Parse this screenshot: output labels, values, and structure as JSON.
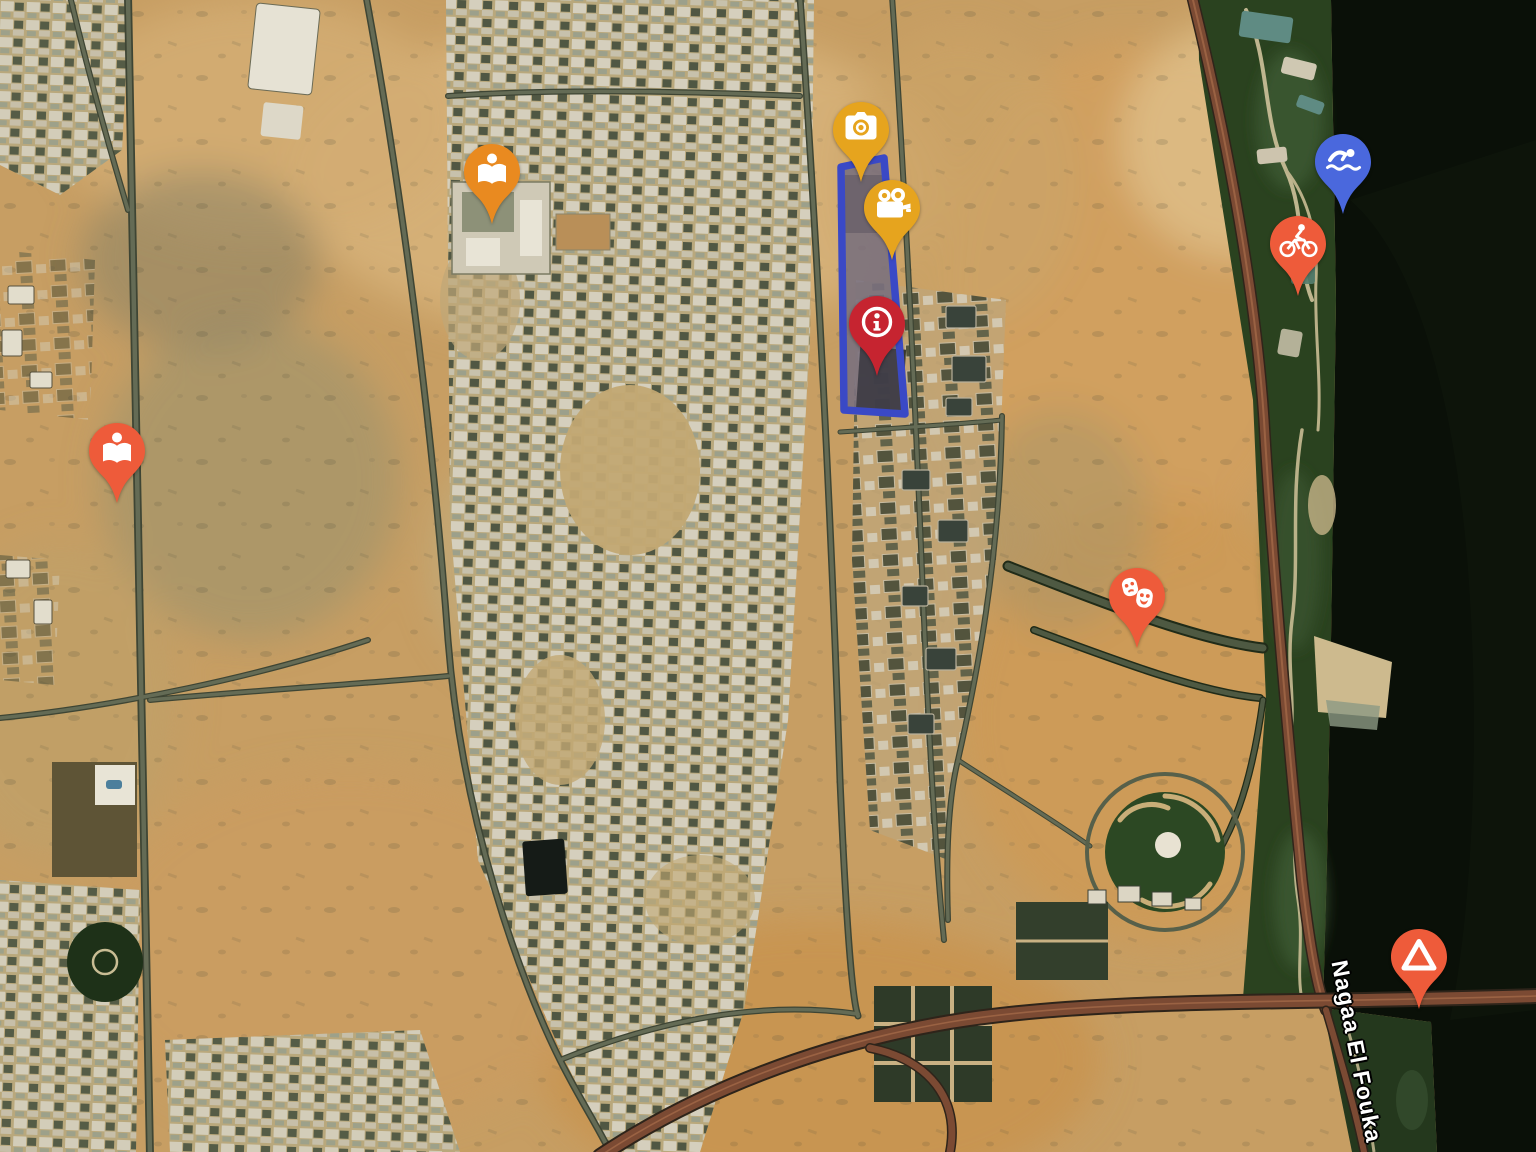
{
  "map": {
    "view": "satellite",
    "road_label": "Nagaa El Fouka",
    "highlight_polygon": {
      "stroke_color": "#3A49C6",
      "fill_color": "rgba(110,100,150,0.28)",
      "path": "M841 167 L884 158 L905 414 L844 410 Z"
    },
    "markers": [
      {
        "name": "library-marker-north",
        "icon": "local-library",
        "color": "#E98A20",
        "x": 492,
        "y": 170
      },
      {
        "name": "photo-spot-marker",
        "icon": "photo-camera",
        "color": "#E6A41E",
        "x": 861,
        "y": 128
      },
      {
        "name": "video-spot-marker",
        "icon": "video-camera",
        "color": "#E6A41E",
        "x": 892,
        "y": 206
      },
      {
        "name": "info-marker",
        "icon": "info",
        "color": "#C62430",
        "x": 877,
        "y": 322
      },
      {
        "name": "swimming-marker",
        "icon": "swimming",
        "color": "#4A68DD",
        "x": 1343,
        "y": 160
      },
      {
        "name": "cycling-marker",
        "icon": "cycling",
        "color": "#EE5B3A",
        "x": 1298,
        "y": 242
      },
      {
        "name": "library-marker-west",
        "icon": "local-library",
        "color": "#EE5B3A",
        "x": 117,
        "y": 449
      },
      {
        "name": "theater-marker",
        "icon": "theater-masks",
        "color": "#EE5B3A",
        "x": 1137,
        "y": 594
      },
      {
        "name": "camping-marker",
        "icon": "camping-tent",
        "color": "#EE5B3A",
        "x": 1419,
        "y": 955
      }
    ]
  }
}
